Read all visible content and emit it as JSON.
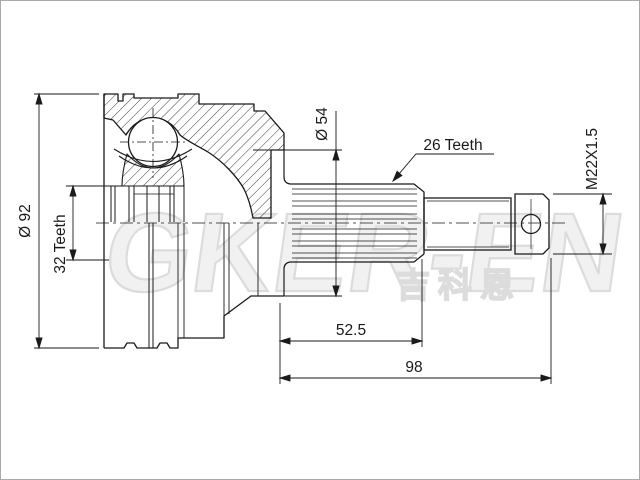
{
  "page": {
    "background": "#ffffff",
    "border_color": "#aaaaaa",
    "line_color": "#1a1a1a"
  },
  "drawing": {
    "kind": "cv-joint-outer-section-technical-drawing",
    "labels": {
      "outer_diameter": "Ø 92",
      "inner_spline_teeth": "32 Teeth",
      "boot_seat_diameter": "Ø 54",
      "shaft_spline_teeth": "26 Teeth",
      "thread_spec": "M22X1.5",
      "spline_length": "52.5",
      "shaft_length": "98"
    },
    "watermark": {
      "latin": "GKER-EN",
      "cjk": "吉科恩",
      "color": "#dcdcdc"
    }
  }
}
